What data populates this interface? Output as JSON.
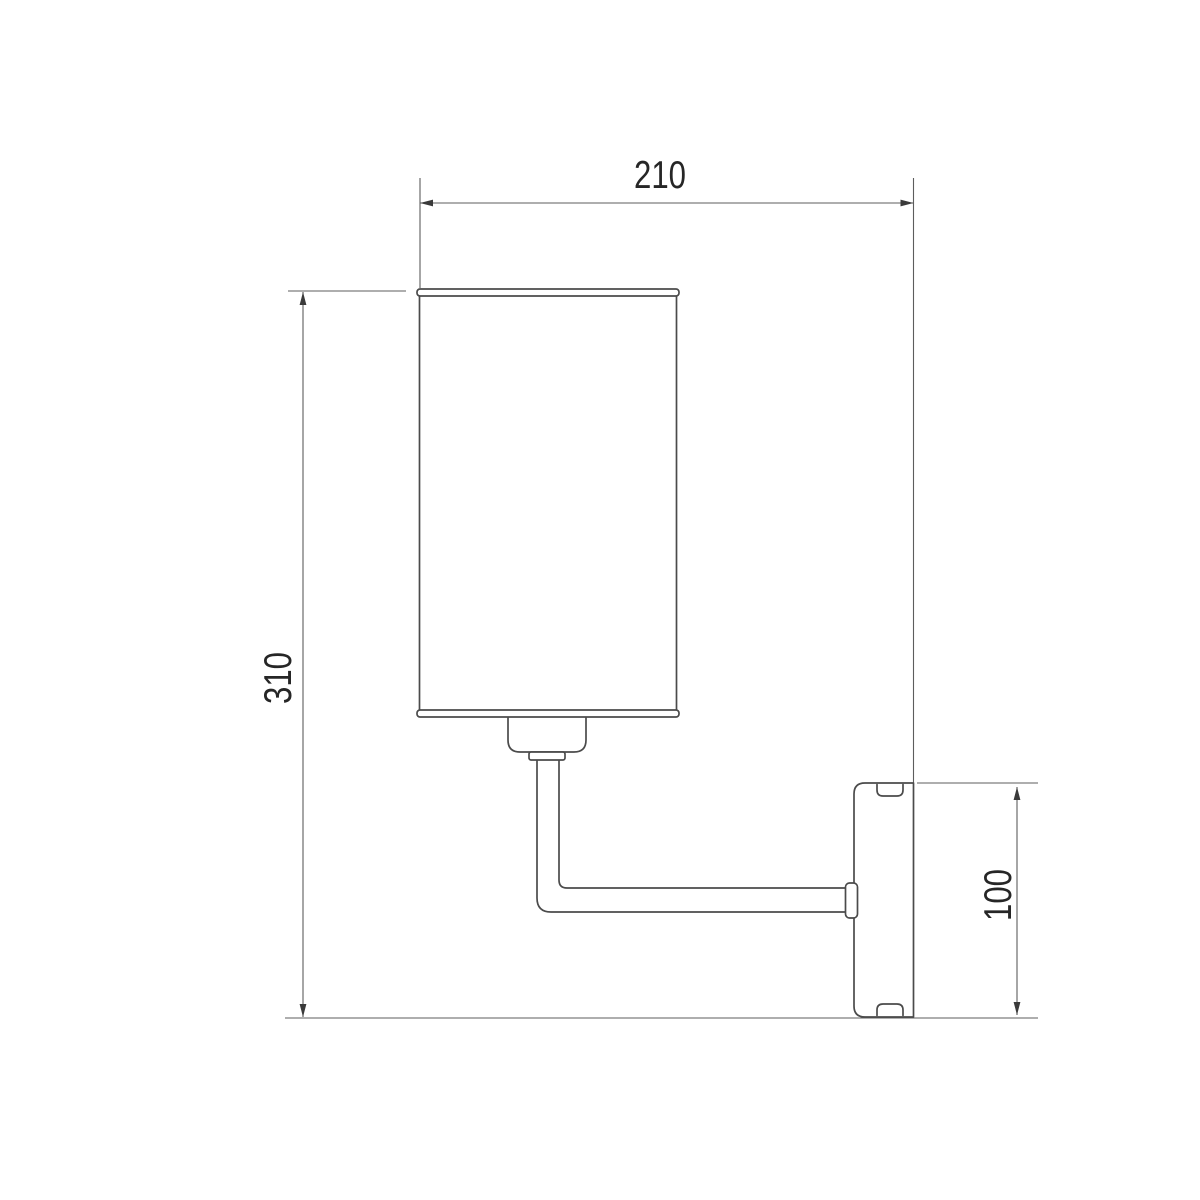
{
  "drawing": {
    "name": "wall-sconce-dimension-drawing",
    "dimensions": {
      "width": {
        "value": "210",
        "orientation": "horizontal",
        "location": "top"
      },
      "height": {
        "value": "310",
        "orientation": "vertical",
        "location": "left"
      },
      "plate_height": {
        "value": "100",
        "orientation": "vertical",
        "location": "right"
      }
    },
    "parts": [
      "lampshade",
      "socket",
      "arm",
      "wall-plate"
    ],
    "colors": {
      "object_line": "#4b4b4b",
      "dimension_line": "#5d5d5d",
      "arrow": "#3a3a3a",
      "text": "#262626",
      "background": "#ffffff"
    }
  }
}
